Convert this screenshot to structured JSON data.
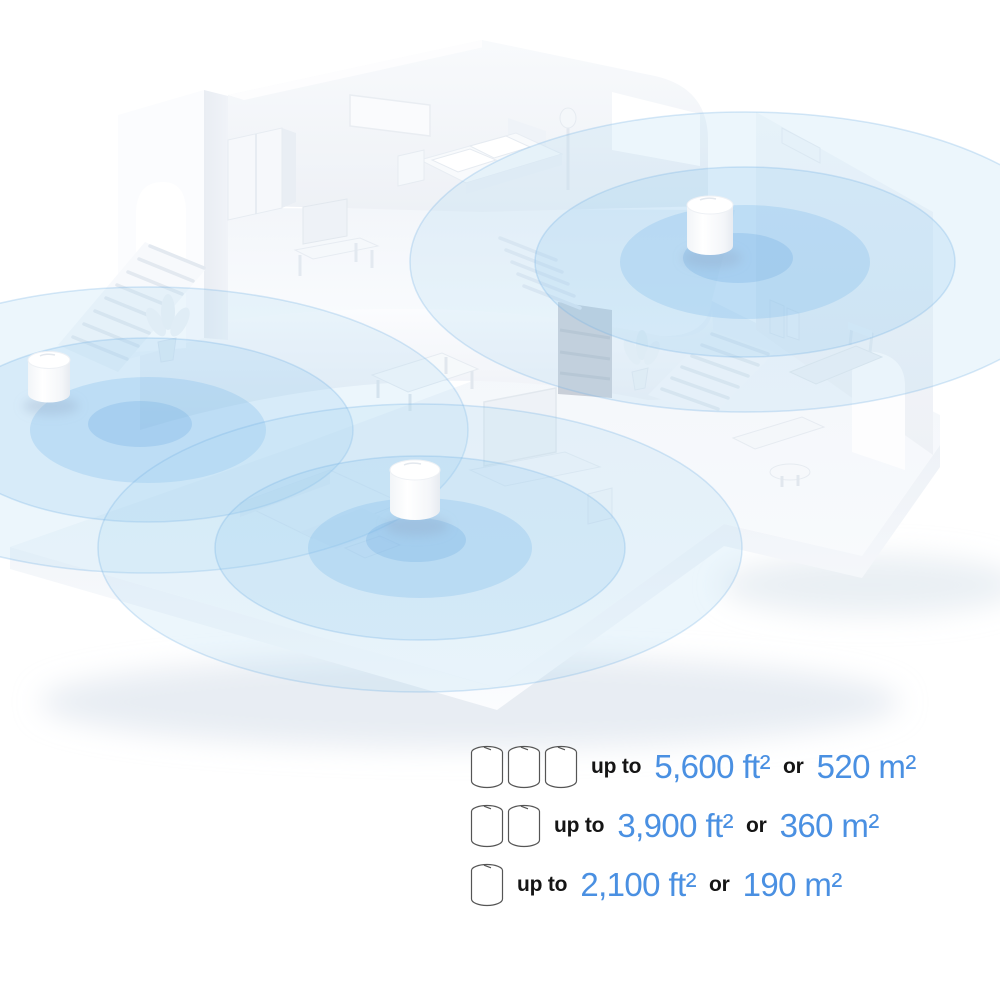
{
  "illustration": {
    "description": "Isometric white smart-home floor plan with three mesh Wi-Fi units and blue coverage circles",
    "colors": {
      "coverage_outer": "#cfe6f7",
      "coverage_mid": "#aed6f1",
      "coverage_inner": "#8fc2e8",
      "wall": "#f5f8fb",
      "wall_shade": "#e9eef4",
      "unit": "#ffffff"
    },
    "units": [
      {
        "name": "bedroom unit"
      },
      {
        "name": "entry unit"
      },
      {
        "name": "living room unit"
      }
    ]
  },
  "legend": {
    "accent_color": "#4a90e2",
    "text_color": "#151515",
    "rows": [
      {
        "units": 3,
        "prefix": "up to",
        "ft": "5,600 ft²",
        "conj": "or",
        "m": "520 m²"
      },
      {
        "units": 2,
        "prefix": "up to",
        "ft": "3,900 ft²",
        "conj": "or",
        "m": "360 m²"
      },
      {
        "units": 1,
        "prefix": "up to",
        "ft": "2,100 ft²",
        "conj": "or",
        "m": "190 m²"
      }
    ]
  }
}
